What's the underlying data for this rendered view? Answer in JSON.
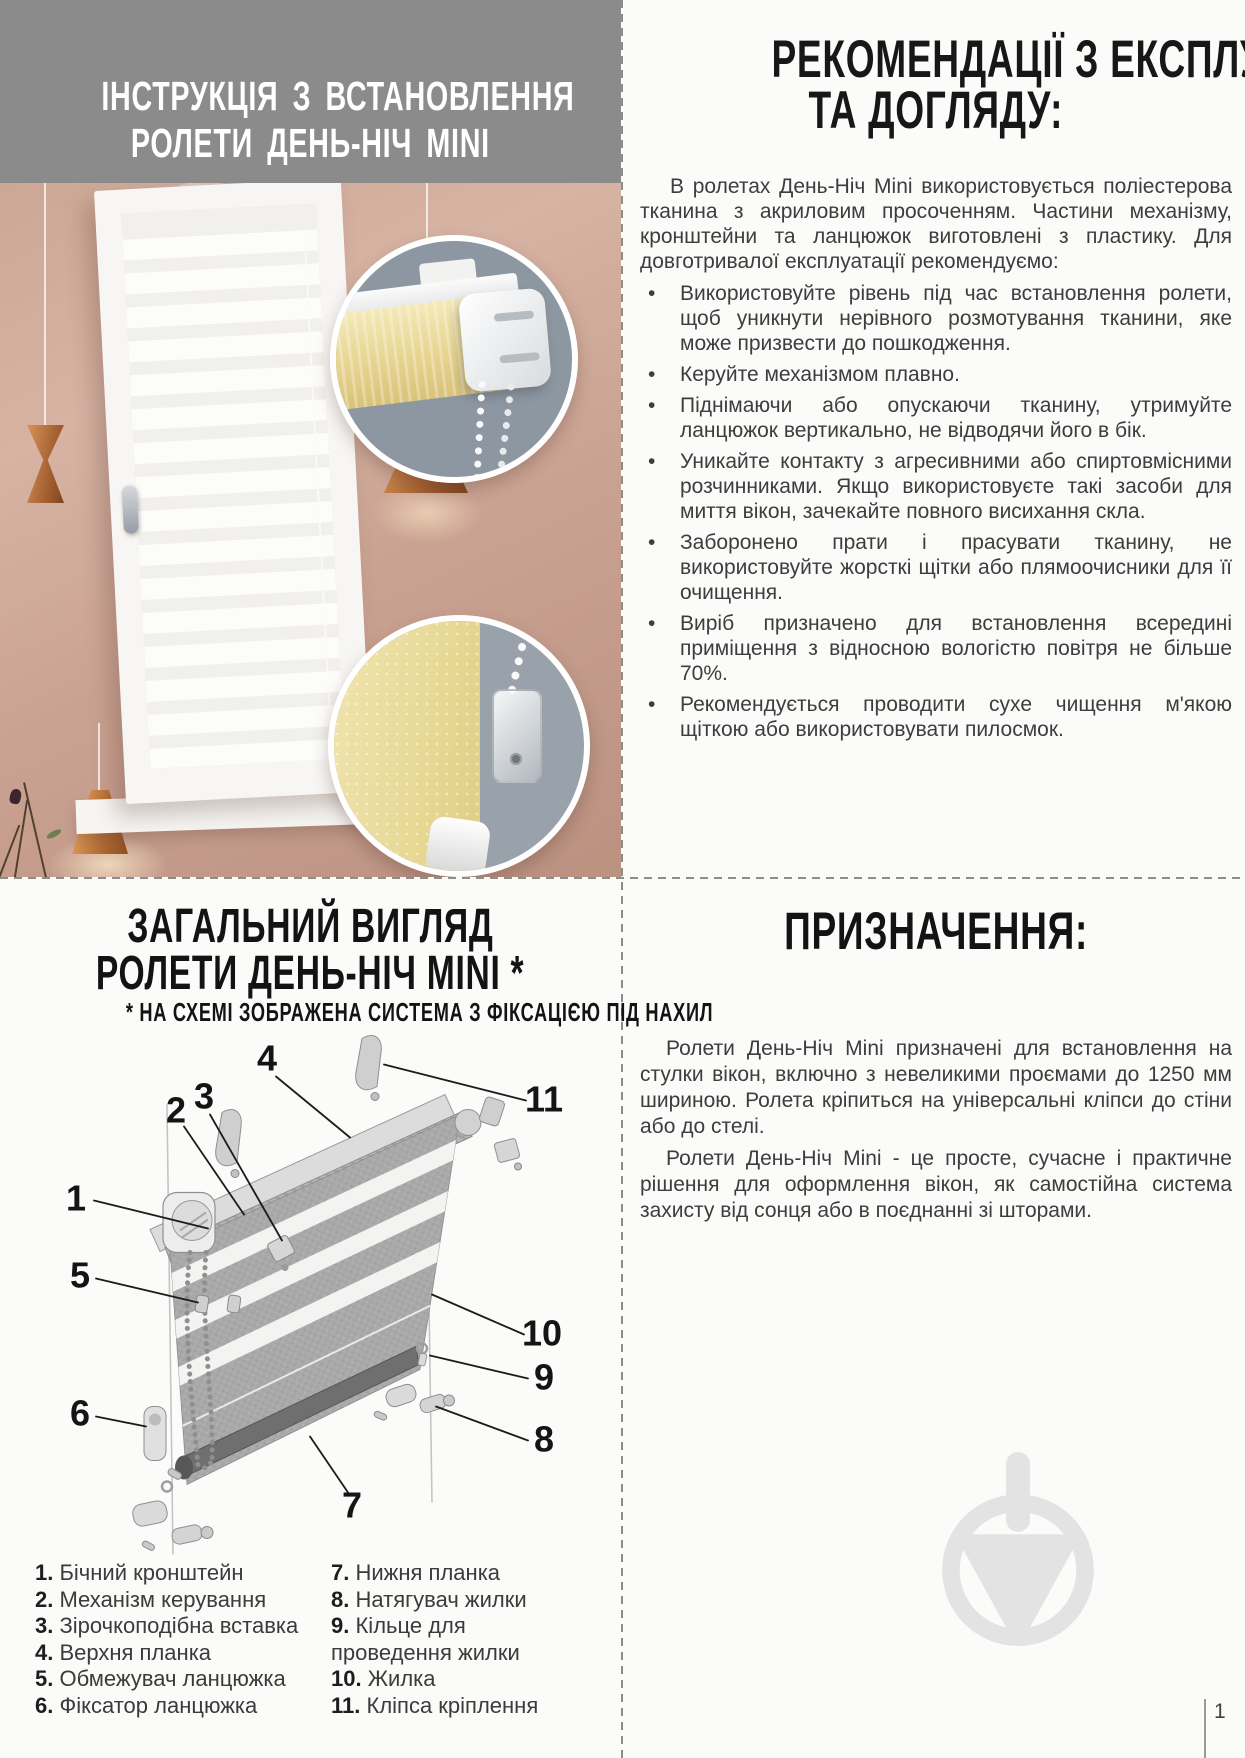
{
  "top_left": {
    "title_line1": "ІНСТРУКЦІЯ З ВСТАНОВЛЕННЯ",
    "title_line2": "РОЛЕТИ ДЕНЬ-НІЧ MINI"
  },
  "top_right": {
    "heading_line1": "РЕКОМЕНДАЦІЇ З ЕКСПЛУАТАЦІЇ",
    "heading_line2": "ТА ДОГЛЯДУ:",
    "intro": "В ролетах День-Ніч Mini використовується поліестерова тканина з акриловим просоченням. Частини механізму, кронштейни та ланцюжок виготовлені з пластику. Для довготривалої експлуатації рекомендуємо:",
    "bullet_char": "•",
    "bullets": [
      "Використовуйте рівень під час встановлення ролети, щоб уникнути нерівного розмотування тканини, яке може призвести до пошкодження.",
      "Керуйте механізмом плавно.",
      "Піднімаючи або опускаючи тканину, утримуйте ланцюжок вертикально, не відводячи його в бік.",
      "Уникайте контакту з агресивними або спиртовмісними розчинниками. Якщо використовуєте такі засоби для миття вікон, зачекайте повного висихання скла.",
      "Заборонено прати і прасувати тканину, не використовуйте жорсткі щітки або плямоочисники для її очищення.",
      "Виріб призначено для встановлення всередині приміщення з відносною вологістю повітря не більше 70%.",
      "Рекомендується проводити сухе чищення м'якою щіткою або використовувати пилосмок."
    ]
  },
  "bottom_left": {
    "heading_line1": "ЗАГАЛЬНИЙ ВИГЛЯД",
    "heading_line2": "РОЛЕТИ ДЕНЬ-НІЧ MINI *",
    "note": "* НА СХЕМІ ЗОБРАЖЕНА СИСТЕМА З ФІКСАЦІЄЮ ПІД НАХИЛ",
    "callouts": [
      "1",
      "2",
      "3",
      "4",
      "5",
      "6",
      "7",
      "8",
      "9",
      "10",
      "11"
    ],
    "legend_left": [
      {
        "n": "1.",
        "t": "Бічний кронштейн"
      },
      {
        "n": "2.",
        "t": "Механізм керування"
      },
      {
        "n": "3.",
        "t": "Зірочкоподібна вставка"
      },
      {
        "n": "4.",
        "t": "Верхня планка"
      },
      {
        "n": "5.",
        "t": "Обмежувач ланцюжка"
      },
      {
        "n": "6.",
        "t": "Фіксатор ланцюжка"
      }
    ],
    "legend_right": [
      {
        "n": "7.",
        "t": "Нижня планка"
      },
      {
        "n": "8.",
        "t": "Натягувач жилки"
      },
      {
        "n": "9.",
        "t": "Кільце для проведення жилки"
      },
      {
        "n": "10.",
        "t": "Жилка"
      },
      {
        "n": "11.",
        "t": "Кліпса кріплення"
      }
    ]
  },
  "bottom_right": {
    "heading": "ПРИЗНАЧЕННЯ:",
    "para1": "Ролети День-Ніч Mini призначені для встановлення на стулки вікон, включно з невеликими проємами до 1250 мм шириною. Ролета кріпиться на універсальні кліпси до стіни або до стелі.",
    "para2": "Ролети День-Ніч Mini - це просте, сучасне і практичне рішення для оформлення вікон, як самостійна система захисту від сонця або в поєднанні зі шторами."
  },
  "page": {
    "number": "1"
  },
  "colors": {
    "banner_gray": "#8b8b8b",
    "wall_pink": "#cda795",
    "heading_black": "#171717",
    "body_text": "#3d3d3d",
    "blind_yellow": "#e7d490",
    "inset_bluegray": "#8d97a1",
    "watermark_gray": "#e3e3e3"
  }
}
